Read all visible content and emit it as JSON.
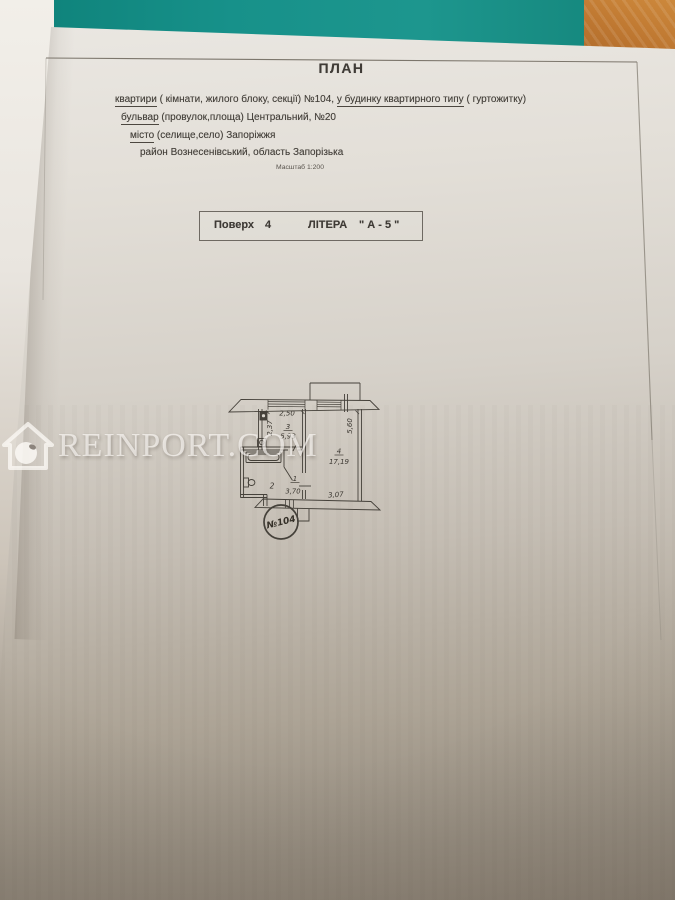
{
  "header": {
    "title": "ПЛАН",
    "line1": {
      "u1": "квартири",
      "t1": " ( кімнати, жилого блоку, секції)  №104, ",
      "u2": "у будинку квартирного типу",
      "t2": " ( гуртожитку)"
    },
    "line2": {
      "u1": "бульвар",
      "t1": " (провулок,площа)  Центральний, №20"
    },
    "line3": {
      "u1": "місто",
      "t1": " (селище,село) Запоріжжя"
    },
    "line4": {
      "t1": "район Вознесенівський,  область Запорізька"
    },
    "scale": "Масштаб 1:200"
  },
  "floor_box": {
    "floor_label": "Поверх",
    "floor_value": "4",
    "letter_label": "ЛІТЕРА",
    "letter_value": "\" А - 5 \""
  },
  "plan": {
    "dim_top": "2,50",
    "dim_left": "2,37",
    "dim_right": "5,60",
    "dim_bottom": "3,07",
    "room3_no": "3",
    "room3_area": "5,93",
    "room4_no": "4",
    "room4_area": "17,19",
    "room2_no": "2",
    "room1_no": "1",
    "room1_area": "3,70",
    "stamp": "№104"
  },
  "watermark": {
    "text": "REINPORT.COM"
  },
  "colors": {
    "desk": "#17918a",
    "wood": "#bd7630",
    "paper": "#d6d1c9",
    "ink": "#423e38"
  }
}
